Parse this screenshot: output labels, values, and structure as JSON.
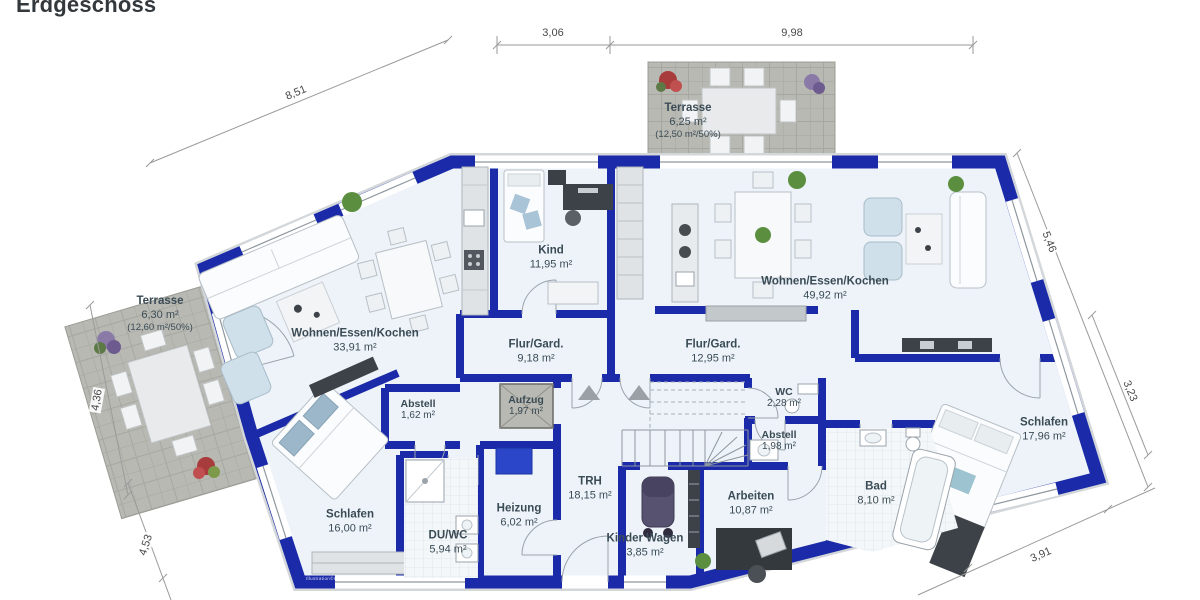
{
  "title": "Erdgeschoss",
  "watermark": "Illustration©ImmoGrafik",
  "colors": {
    "wall": "#1a2aa8",
    "floor": "#edf3f9",
    "terrace": "#b9b9b3",
    "label": "#3a4b55",
    "dimension": "#494949",
    "boiler": "#2b46c8"
  },
  "rooms": [
    {
      "id": "terrasse-left",
      "name": "Terrasse",
      "area": "6,30 m²",
      "note": "(12,60 m²/50%)"
    },
    {
      "id": "terrasse-top",
      "name": "Terrasse",
      "area": "6,25 m²",
      "note": "(12,50 m²/50%)"
    },
    {
      "id": "wohnen-left",
      "name": "Wohnen/Essen/Kochen",
      "area": "33,91 m²"
    },
    {
      "id": "kind",
      "name": "Kind",
      "area": "11,95 m²"
    },
    {
      "id": "wohnen-right",
      "name": "Wohnen/Essen/Kochen",
      "area": "49,92 m²"
    },
    {
      "id": "flur-left",
      "name": "Flur/Gard.",
      "area": "9,18 m²"
    },
    {
      "id": "flur-right",
      "name": "Flur/Gard.",
      "area": "12,95 m²"
    },
    {
      "id": "wc",
      "name": "WC",
      "area": "2,28 m²"
    },
    {
      "id": "abstell-left",
      "name": "Abstell",
      "area": "1,62 m²"
    },
    {
      "id": "aufzug",
      "name": "Aufzug",
      "area": "1,97 m²"
    },
    {
      "id": "abstell-right",
      "name": "Abstell",
      "area": "1,98 m²"
    },
    {
      "id": "schlafen-right",
      "name": "Schlafen",
      "area": "17,96 m²"
    },
    {
      "id": "trh",
      "name": "TRH",
      "area": "18,15 m²"
    },
    {
      "id": "heizung",
      "name": "Heizung",
      "area": "6,02 m²"
    },
    {
      "id": "schlafen-left",
      "name": "Schlafen",
      "area": "16,00 m²"
    },
    {
      "id": "duwc",
      "name": "DU/WC",
      "area": "5,94 m²"
    },
    {
      "id": "kinderwagen",
      "name": "Kinder Wagen",
      "area": "3,85 m²"
    },
    {
      "id": "arbeiten",
      "name": "Arbeiten",
      "area": "10,87 m²"
    },
    {
      "id": "bad",
      "name": "Bad",
      "area": "8,10 m²"
    }
  ],
  "dimensions": [
    {
      "id": "d-851",
      "value": "8,51"
    },
    {
      "id": "d-306",
      "value": "3,06"
    },
    {
      "id": "d-998",
      "value": "9,98"
    },
    {
      "id": "d-546",
      "value": "5,46"
    },
    {
      "id": "d-323",
      "value": "3,23"
    },
    {
      "id": "d-436",
      "value": "4,36"
    },
    {
      "id": "d-453",
      "value": "4,53"
    },
    {
      "id": "d-391",
      "value": "3,91"
    }
  ]
}
